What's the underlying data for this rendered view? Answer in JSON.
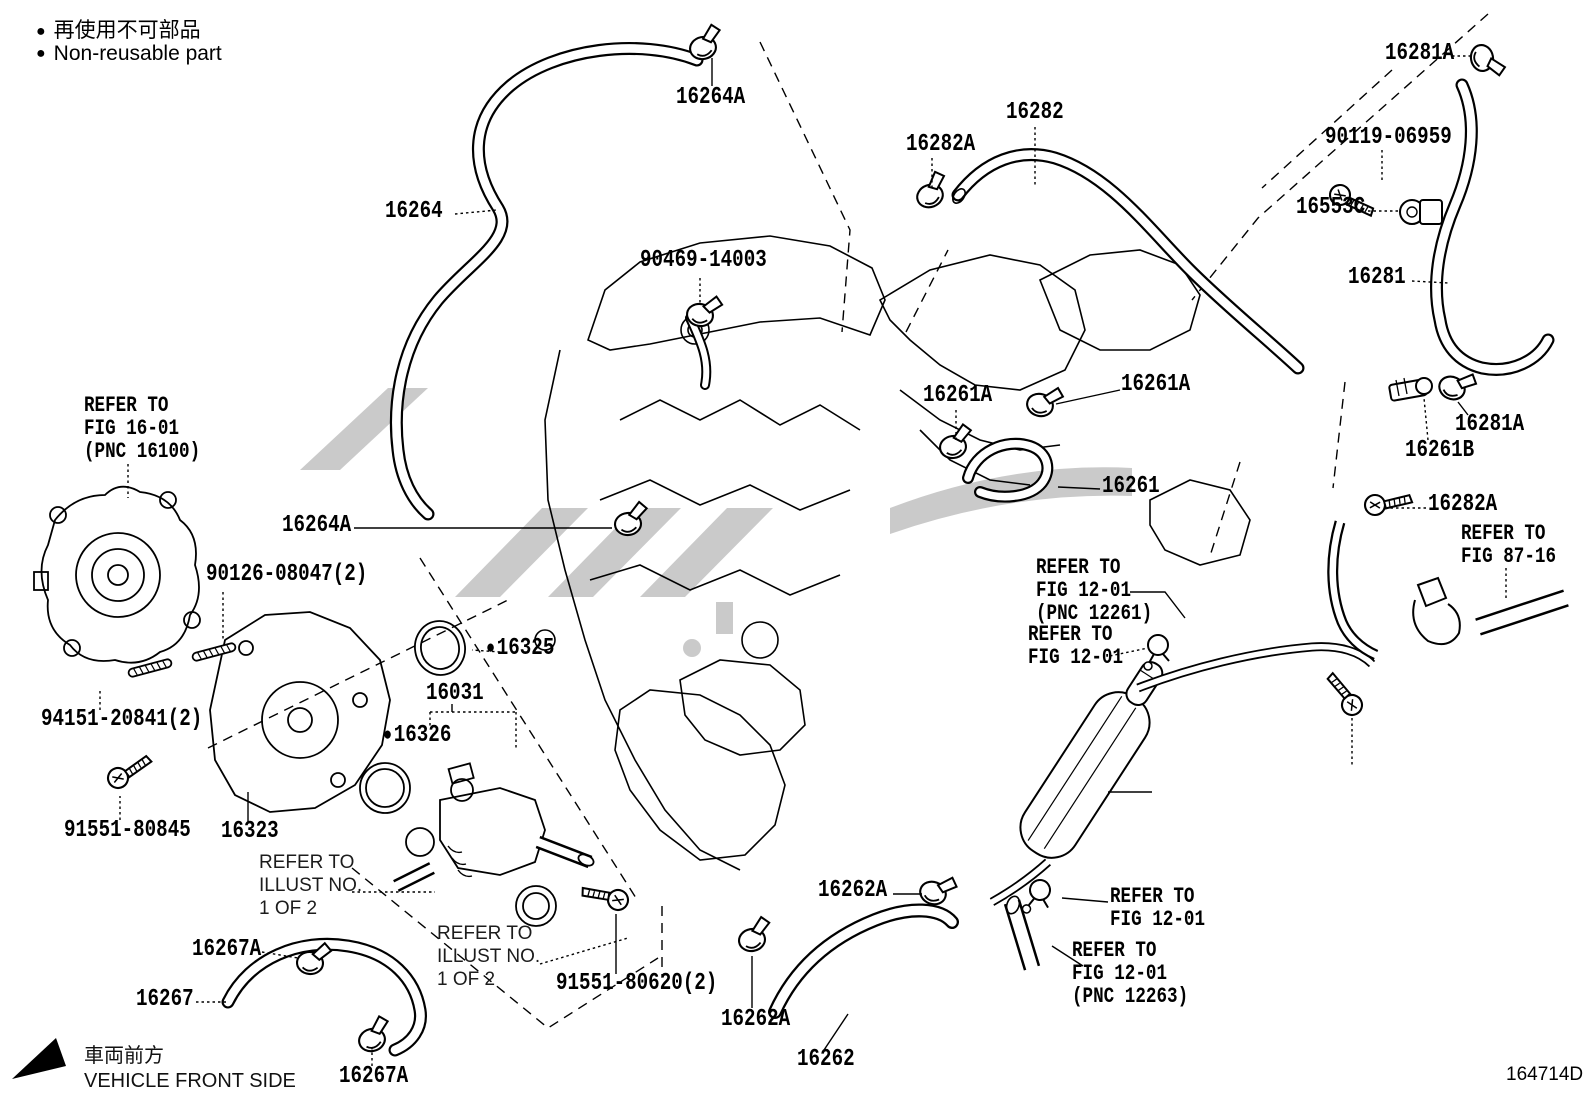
{
  "page": {
    "background": "#ffffff",
    "line_color": "#000000",
    "watermark_color": "#cacaca"
  },
  "legend": {
    "bullet": "●",
    "jp": "再使用不可部品",
    "en": "Non-reusable part"
  },
  "footer": {
    "front_jp": "車両前方",
    "front_en": "VEHICLE FRONT SIDE",
    "doc_number": "164714D"
  },
  "icons": {
    "clamp": "hose-clamp-icon",
    "bolt": "bolt-icon",
    "stud": "stud-bolt-icon",
    "clip": "pipe-clip-icon",
    "bullet": "non-reusable-dot-icon",
    "front_arrow": "vehicle-front-arrow-icon"
  },
  "part_labels": [
    {
      "name": "label-16264a-top",
      "text": "16264A",
      "x": 676,
      "y": 86
    },
    {
      "name": "label-16281a-top",
      "text": "16281A",
      "x": 1385,
      "y": 42
    },
    {
      "name": "label-16282",
      "text": "16282",
      "x": 1006,
      "y": 101
    },
    {
      "name": "label-16282a-top",
      "text": "16282A",
      "x": 906,
      "y": 133
    },
    {
      "name": "label-90119-06959",
      "text": "90119-06959",
      "x": 1325,
      "y": 126
    },
    {
      "name": "label-16553c",
      "text": "16553C",
      "x": 1296,
      "y": 196
    },
    {
      "name": "label-16264",
      "text": "16264",
      "x": 385,
      "y": 200
    },
    {
      "name": "label-90469-14003",
      "text": "90469-14003",
      "x": 640,
      "y": 249
    },
    {
      "name": "label-16281",
      "text": "16281",
      "x": 1348,
      "y": 266
    },
    {
      "name": "label-16261a-right",
      "text": "16261A",
      "x": 1121,
      "y": 373
    },
    {
      "name": "label-16261a-left",
      "text": "16261A",
      "x": 923,
      "y": 384
    },
    {
      "name": "label-16281a-mid",
      "text": "16281A",
      "x": 1455,
      "y": 413
    },
    {
      "name": "label-16261b",
      "text": "16261B",
      "x": 1405,
      "y": 439
    },
    {
      "name": "label-16261",
      "text": "16261",
      "x": 1102,
      "y": 475
    },
    {
      "name": "label-16282a-mid",
      "text": "16282A",
      "x": 1428,
      "y": 493
    },
    {
      "name": "note-refer-fig-87-16-upper",
      "text": "REFER TO\nFIG 87-16",
      "x": 1461,
      "y": 522,
      "style": "note"
    },
    {
      "name": "note-refer-fig-16-01",
      "text": "REFER TO\nFIG 16-01\n(PNC 16100)",
      "x": 84,
      "y": 394,
      "style": "note"
    },
    {
      "name": "label-16264a-mid",
      "text": "16264A",
      "x": 282,
      "y": 514
    },
    {
      "name": "label-90126-08047",
      "text": "90126-08047(2)",
      "x": 206,
      "y": 563
    },
    {
      "name": "note-refer-fig-12-01-pnc12261",
      "text": "REFER TO\nFIG 12-01\n(PNC 12261)",
      "x": 1036,
      "y": 556,
      "style": "note"
    },
    {
      "name": "note-refer-fig-12-01-b",
      "text": "REFER TO\nFIG 12-01",
      "x": 1028,
      "y": 623,
      "style": "note"
    },
    {
      "name": "label-16325",
      "text": "16325",
      "x": 486,
      "y": 637,
      "bullet": true
    },
    {
      "name": "label-16031",
      "text": "16031",
      "x": 426,
      "y": 682
    },
    {
      "name": "label-16326",
      "text": "16326",
      "x": 383,
      "y": 724,
      "bullet": true
    },
    {
      "name": "label-94151-20841",
      "text": "94151-20841(2)",
      "x": 41,
      "y": 708
    },
    {
      "name": "label-91551-80845",
      "text": "91551-80845",
      "x": 64,
      "y": 819
    },
    {
      "name": "label-16323",
      "text": "16323",
      "x": 221,
      "y": 820
    },
    {
      "name": "note-refer-illust-1",
      "text": "REFER TO\nILLUST NO.\n1 OF 2",
      "x": 259,
      "y": 852,
      "style": "sans"
    },
    {
      "name": "label-16262a-upper",
      "text": "16262A",
      "x": 818,
      "y": 879
    },
    {
      "name": "note-refer-fig-12-01-c",
      "text": "REFER TO\nFIG 12-01",
      "x": 1110,
      "y": 885,
      "style": "note"
    },
    {
      "name": "label-16267a-1",
      "text": "16267A",
      "x": 192,
      "y": 938
    },
    {
      "name": "note-refer-illust-2",
      "text": "REFER TO\nILLUST NO.\n1 OF 2",
      "x": 437,
      "y": 923,
      "style": "sans"
    },
    {
      "name": "label-91551-80620",
      "text": "91551-80620(2)",
      "x": 556,
      "y": 972
    },
    {
      "name": "note-refer-fig-12-01-pnc12263",
      "text": "REFER TO\nFIG 12-01\n(PNC 12263)",
      "x": 1072,
      "y": 939,
      "style": "note"
    },
    {
      "name": "label-16267",
      "text": "16267",
      "x": 136,
      "y": 988
    },
    {
      "name": "label-16262a-lower",
      "text": "16262A",
      "x": 721,
      "y": 1008
    },
    {
      "name": "label-16267a-2",
      "text": "16267A",
      "x": 339,
      "y": 1065
    },
    {
      "name": "label-16262",
      "text": "16262",
      "x": 797,
      "y": 1048
    }
  ]
}
